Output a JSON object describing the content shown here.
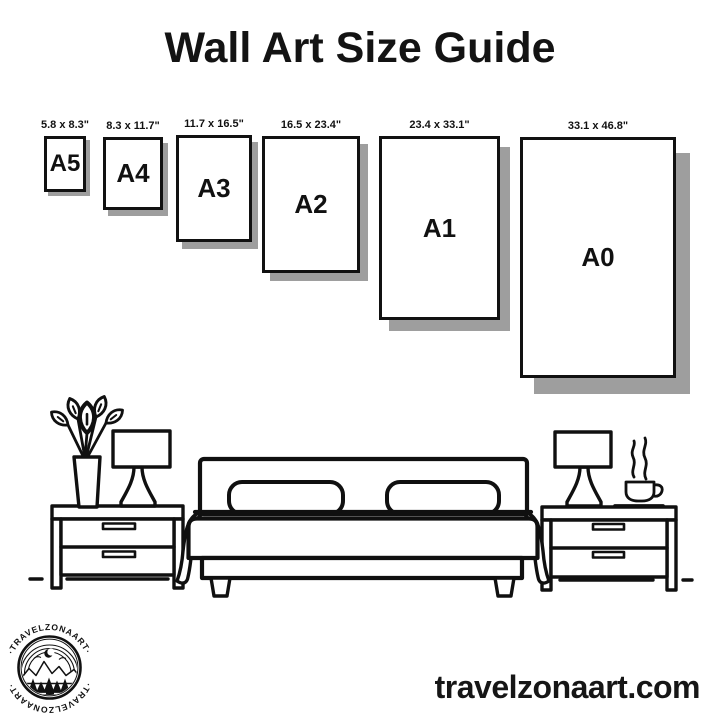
{
  "title": "Wall Art Size Guide",
  "papers": [
    {
      "name": "A5",
      "dims": "5.8 x 8.3\""
    },
    {
      "name": "A4",
      "dims": "8.3 x 11.7\""
    },
    {
      "name": "A3",
      "dims": "11.7 x 16.5\""
    },
    {
      "name": "A2",
      "dims": "16.5 x 23.4\""
    },
    {
      "name": "A1",
      "dims": "23.4 x 33.1\""
    },
    {
      "name": "A0",
      "dims": "33.1 x 46.8\""
    }
  ],
  "logo": {
    "ring_text_top": "·TRAVELZONAART·",
    "ring_text_bottom": "·TRAVELZONAART·"
  },
  "footer": {
    "website": "travelzonaart.com"
  },
  "colors": {
    "ink": "#111111",
    "shadow": "#9e9e9e",
    "background": "#ffffff"
  },
  "illustration": {
    "icons": [
      "flower-vase-icon",
      "table-lamp-icon",
      "nightstand-icon",
      "bed-icon",
      "coffee-cup-icon"
    ]
  }
}
